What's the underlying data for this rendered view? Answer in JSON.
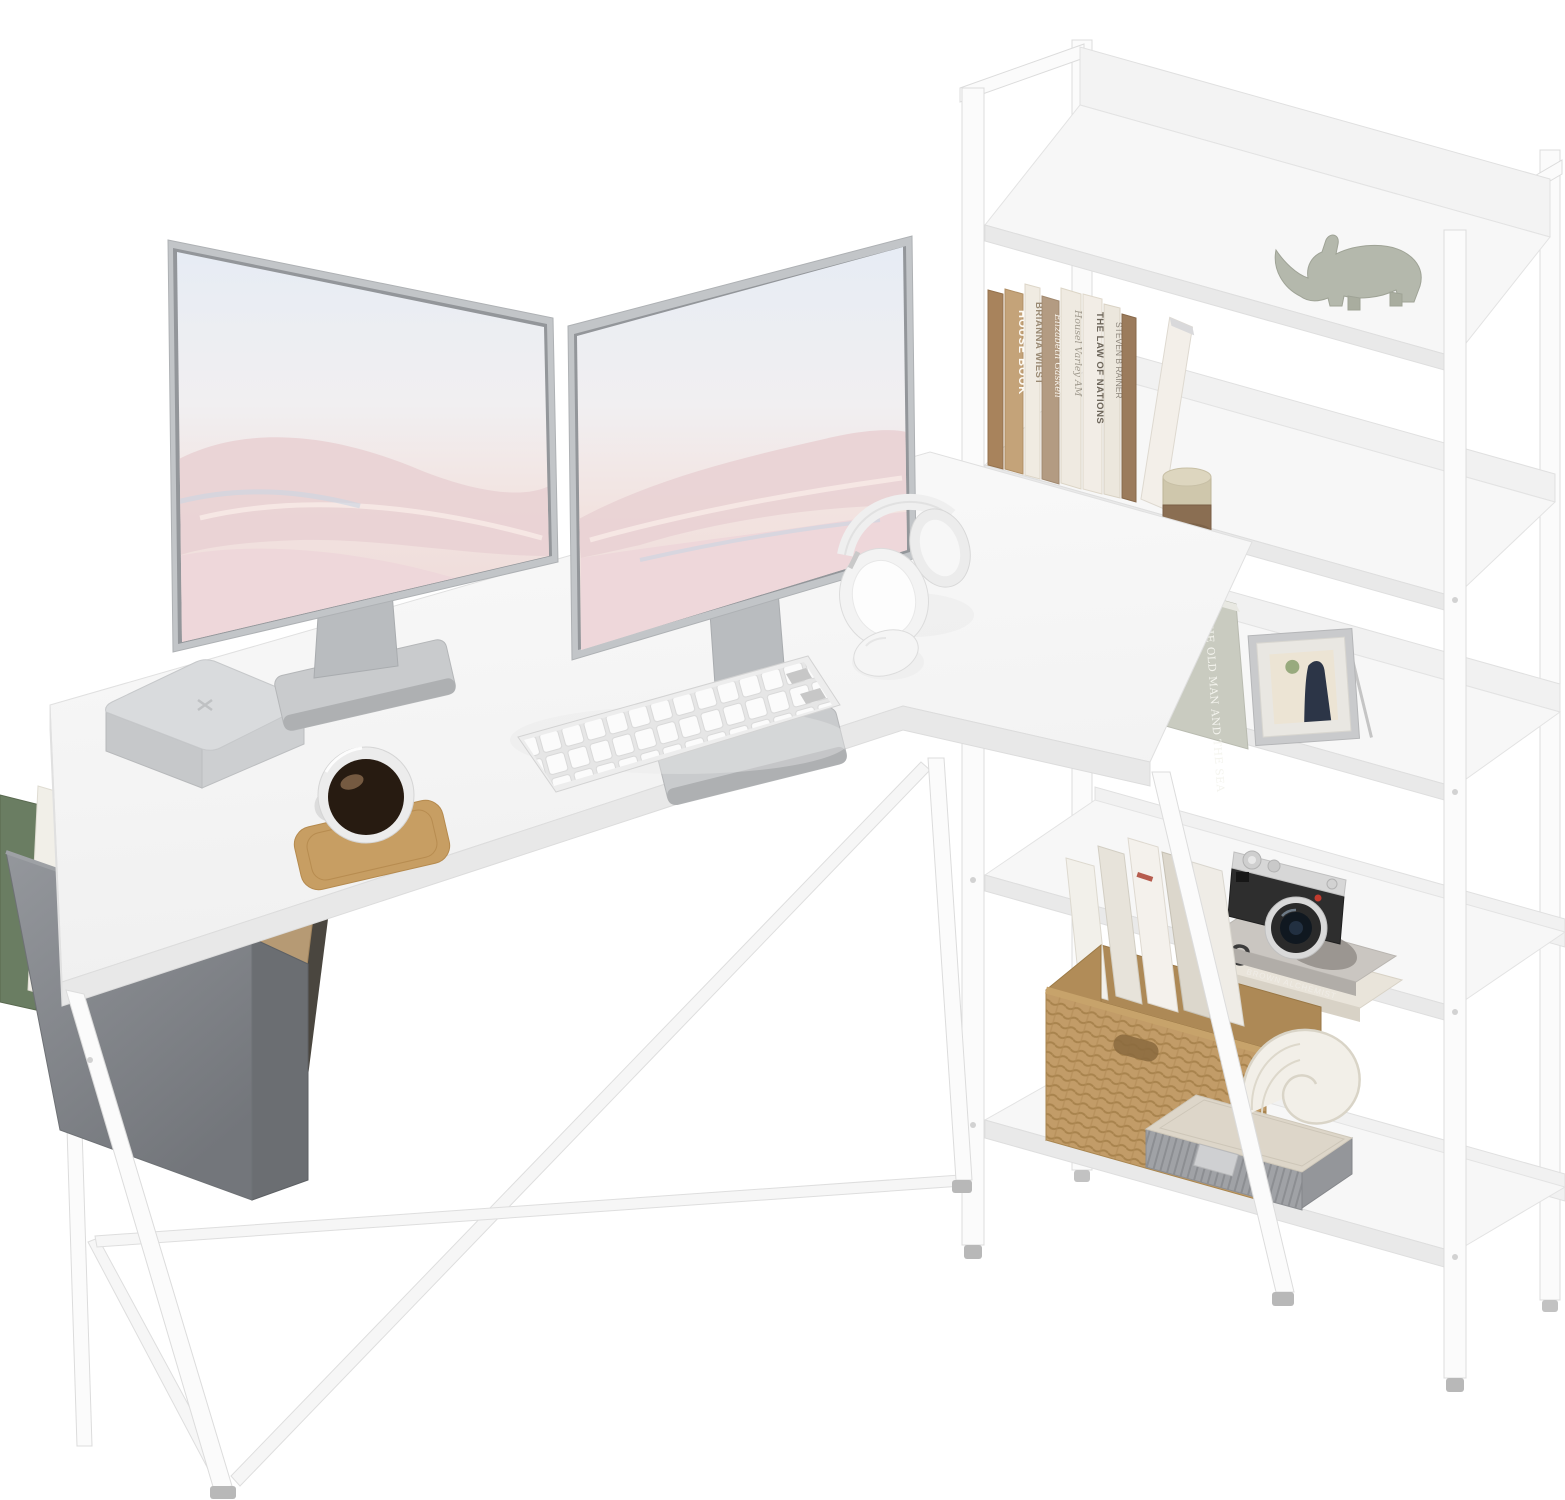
{
  "product": {
    "name": "White L-shaped computer desk with integrated 4-tier corner bookshelf",
    "photo_style": "cut-out product photo on white background",
    "colors": {
      "surface": "#f7f7f7",
      "frame": "#fbfbfb",
      "edge": "#e2e2e2",
      "bag_fabric": "#85888d",
      "wood_coaster": "#c79e63",
      "wicker": "#c29c68",
      "camera_black": "#2e2e2e",
      "camera_silver": "#d7d7d7",
      "wallpaper_sky": "#e6ecf4",
      "wallpaper_sand": "#eed9d8"
    }
  },
  "monitors": {
    "count": 2,
    "wallpaper": "pastel desert dunes"
  },
  "desk_items": {
    "computer": "mac mini style computer",
    "drink": "glass mug of coffee on wooden coaster",
    "keyboard": "white wireless keyboard with numpad",
    "mouse": "white wireless mouse",
    "headphones": "white over-ear headphones"
  },
  "storage_bag": {
    "notebook_title": "Office book",
    "book_title": "VANWA"
  },
  "shelf": {
    "tier1": {
      "decor": "rhino figurine"
    },
    "books_desk_level": [
      {
        "title": "",
        "color": "#a8835c"
      },
      {
        "title": "HOUSE BOOK",
        "color": "#c4a379"
      },
      {
        "title": "BRIANNA WIEST",
        "color": "#f0ebe2"
      },
      {
        "title": "Elizabeth Gaskell",
        "color": "#b39b82"
      },
      {
        "title": "Housel Varley AM",
        "color": "#efeae1"
      },
      {
        "title": "THE LAW OF NATIONS",
        "color": "#f2ede6"
      },
      {
        "title": "STEVEN B RAINER",
        "color": "#ece7dd"
      },
      {
        "title": "",
        "color": "#9b7b5c"
      },
      {
        "title": "",
        "color": "#f3efe9"
      }
    ],
    "candle_jar": "two-tone candle jar",
    "tier3": {
      "featured_book": "THE OLD MAN AND THE SEA",
      "decor": "silver picture frame"
    },
    "tier4": {
      "magazine_letter": "C",
      "magazine_title": "BROWN ALCHEMIST",
      "decor": "vintage rangefinder camera"
    },
    "tier5": {
      "basket": "wicker basket with magazines",
      "shell": "white shell ornament",
      "box": "grey storage box"
    }
  }
}
